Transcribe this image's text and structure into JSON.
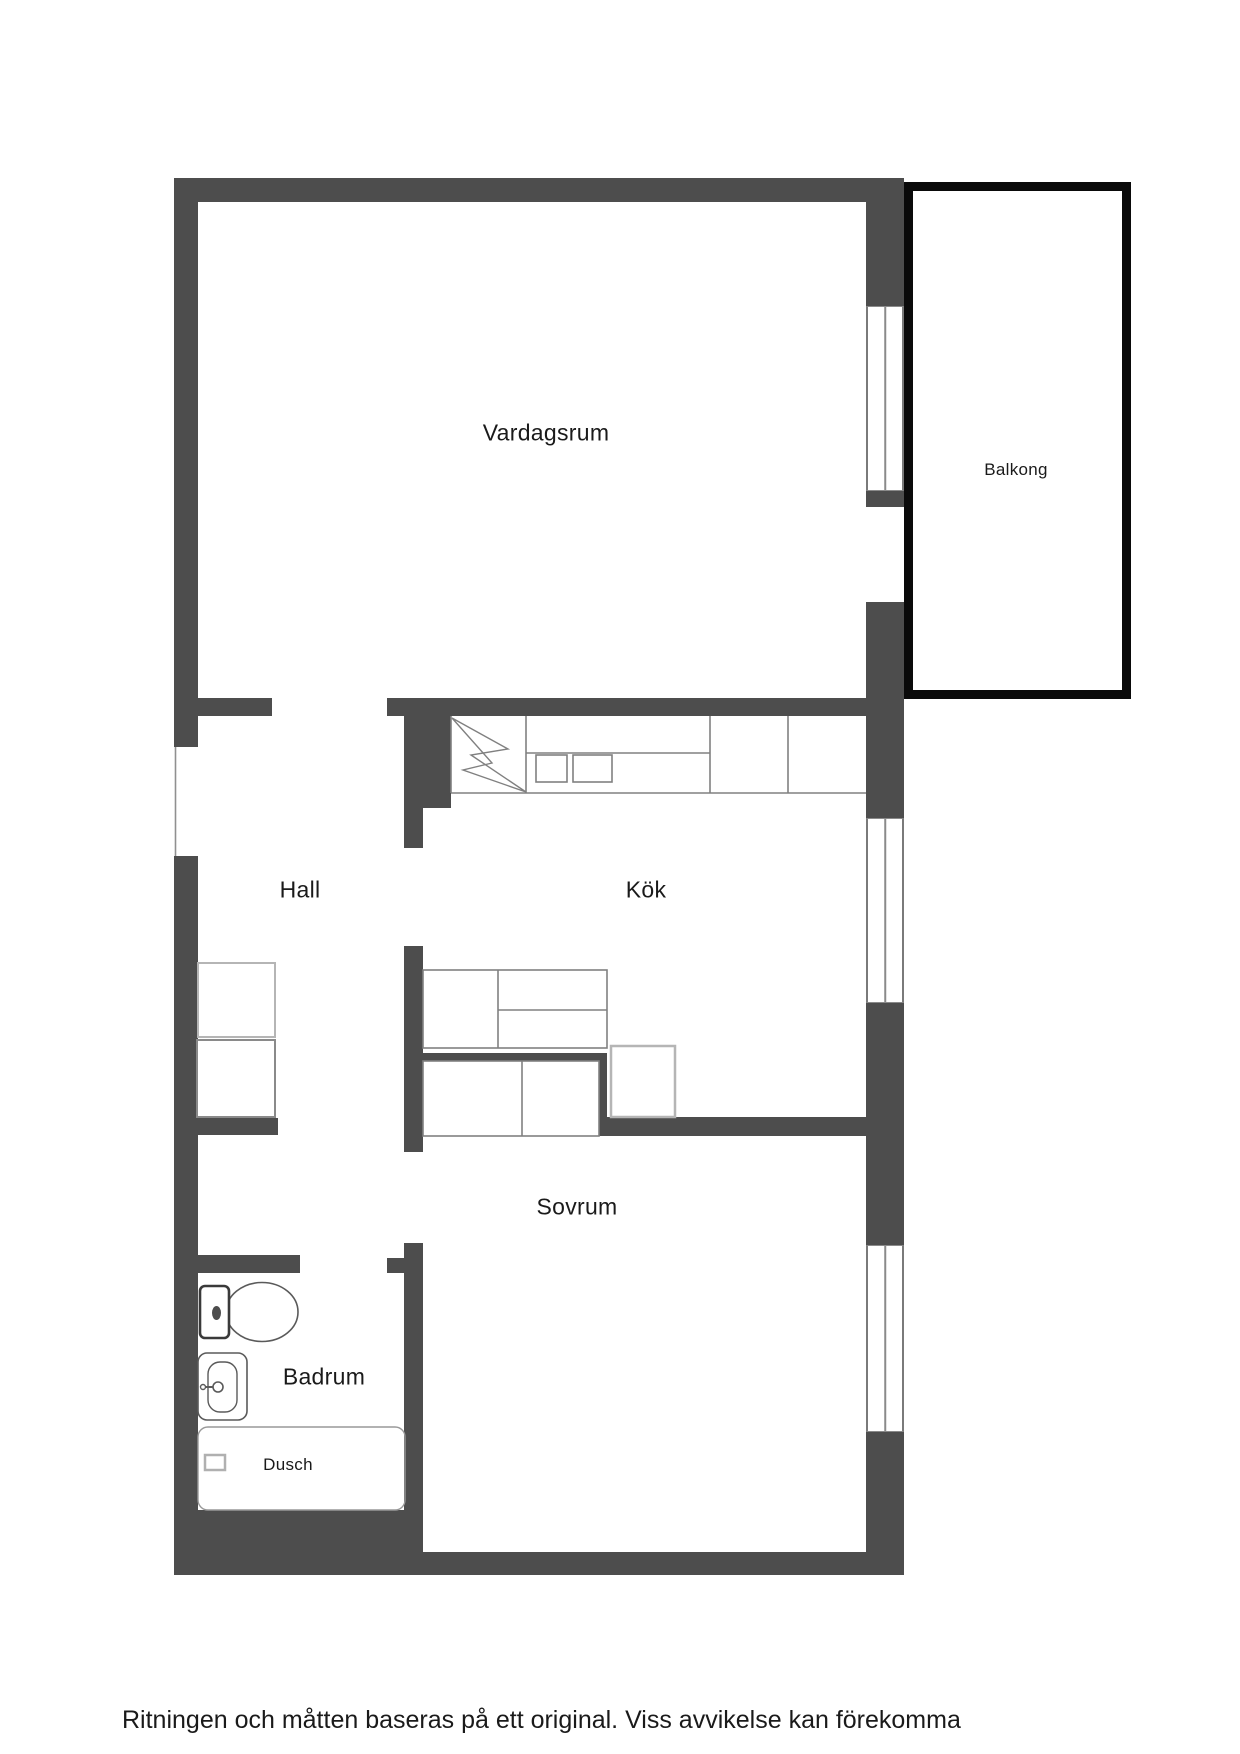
{
  "plan": {
    "type": "apartment-floor-plan",
    "colors": {
      "wall": "#4d4d4d",
      "balcony_border": "#0a0a0a",
      "thin_line": "#808080",
      "light_outline": "#b5b5b5",
      "text": "#1a1a1a"
    },
    "rooms": [
      {
        "id": "vardagsrum",
        "label": "Vardagsrum"
      },
      {
        "id": "balkong",
        "label": "Balkong"
      },
      {
        "id": "hall",
        "label": "Hall"
      },
      {
        "id": "kok",
        "label": "Kök"
      },
      {
        "id": "badrum",
        "label": "Badrum"
      },
      {
        "id": "dusch",
        "label": "Dusch"
      },
      {
        "id": "sovrum",
        "label": "Sovrum"
      }
    ],
    "fixtures": [
      "stove-lightning-symbol",
      "kitchen-counter",
      "sink-basins",
      "lower-cabinets",
      "appliance-box",
      "wardrobe",
      "wardrobe",
      "toilet",
      "washbasin",
      "shower-floor",
      "shower-drain"
    ]
  },
  "footer": {
    "disclaimer": "Ritningen och måtten baseras på ett original. Viss avvikelse kan förekomma"
  }
}
